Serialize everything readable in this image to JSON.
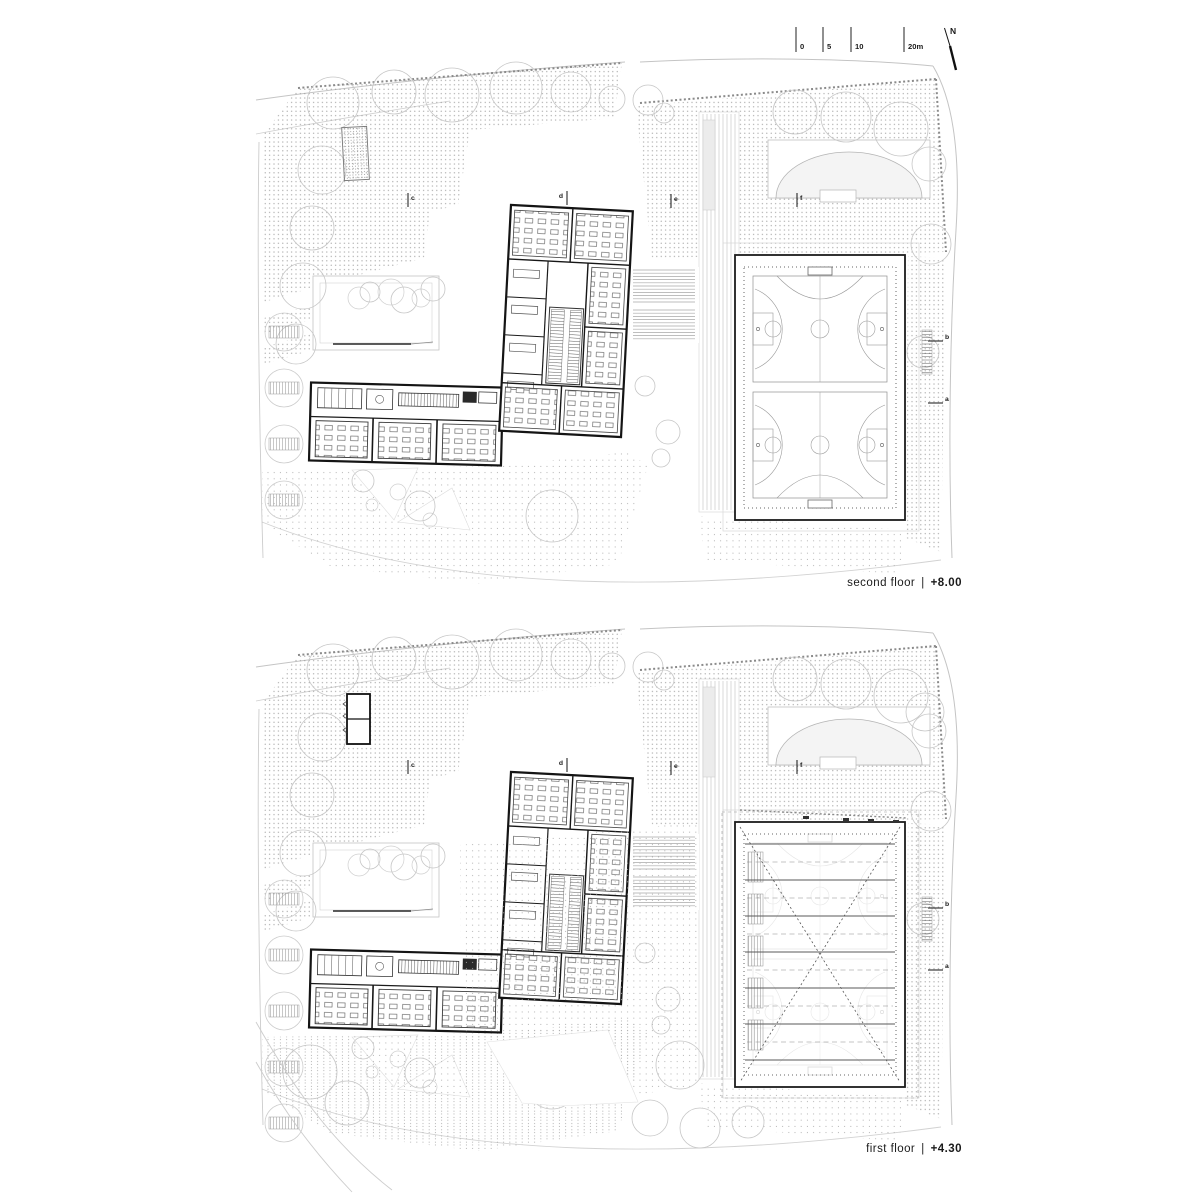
{
  "sheet": {
    "type": "architectural floor plan sheet",
    "background": "#ffffff"
  },
  "colors": {
    "ink": "#1a1a1a",
    "wall": "#141414",
    "light_line": "#c4c4c4",
    "dots": "#9a9a9a",
    "court_line": "#8f8f8f"
  },
  "scale_bar": {
    "ticks": [
      "0",
      "5",
      "10",
      "20m"
    ],
    "north": "N"
  },
  "plans": [
    {
      "id": "second-floor",
      "label": "second floor",
      "separator": "|",
      "elevation": "+8.00",
      "sections": {
        "c": "c",
        "d": "d",
        "e": "e",
        "f": "f",
        "b": "b",
        "a": "a"
      }
    },
    {
      "id": "first-floor",
      "label": "first floor",
      "separator": "|",
      "elevation": "+4.30",
      "sections": {
        "c": "c",
        "d": "d",
        "e": "e",
        "f": "f",
        "b": "b",
        "a": "a"
      }
    }
  ]
}
